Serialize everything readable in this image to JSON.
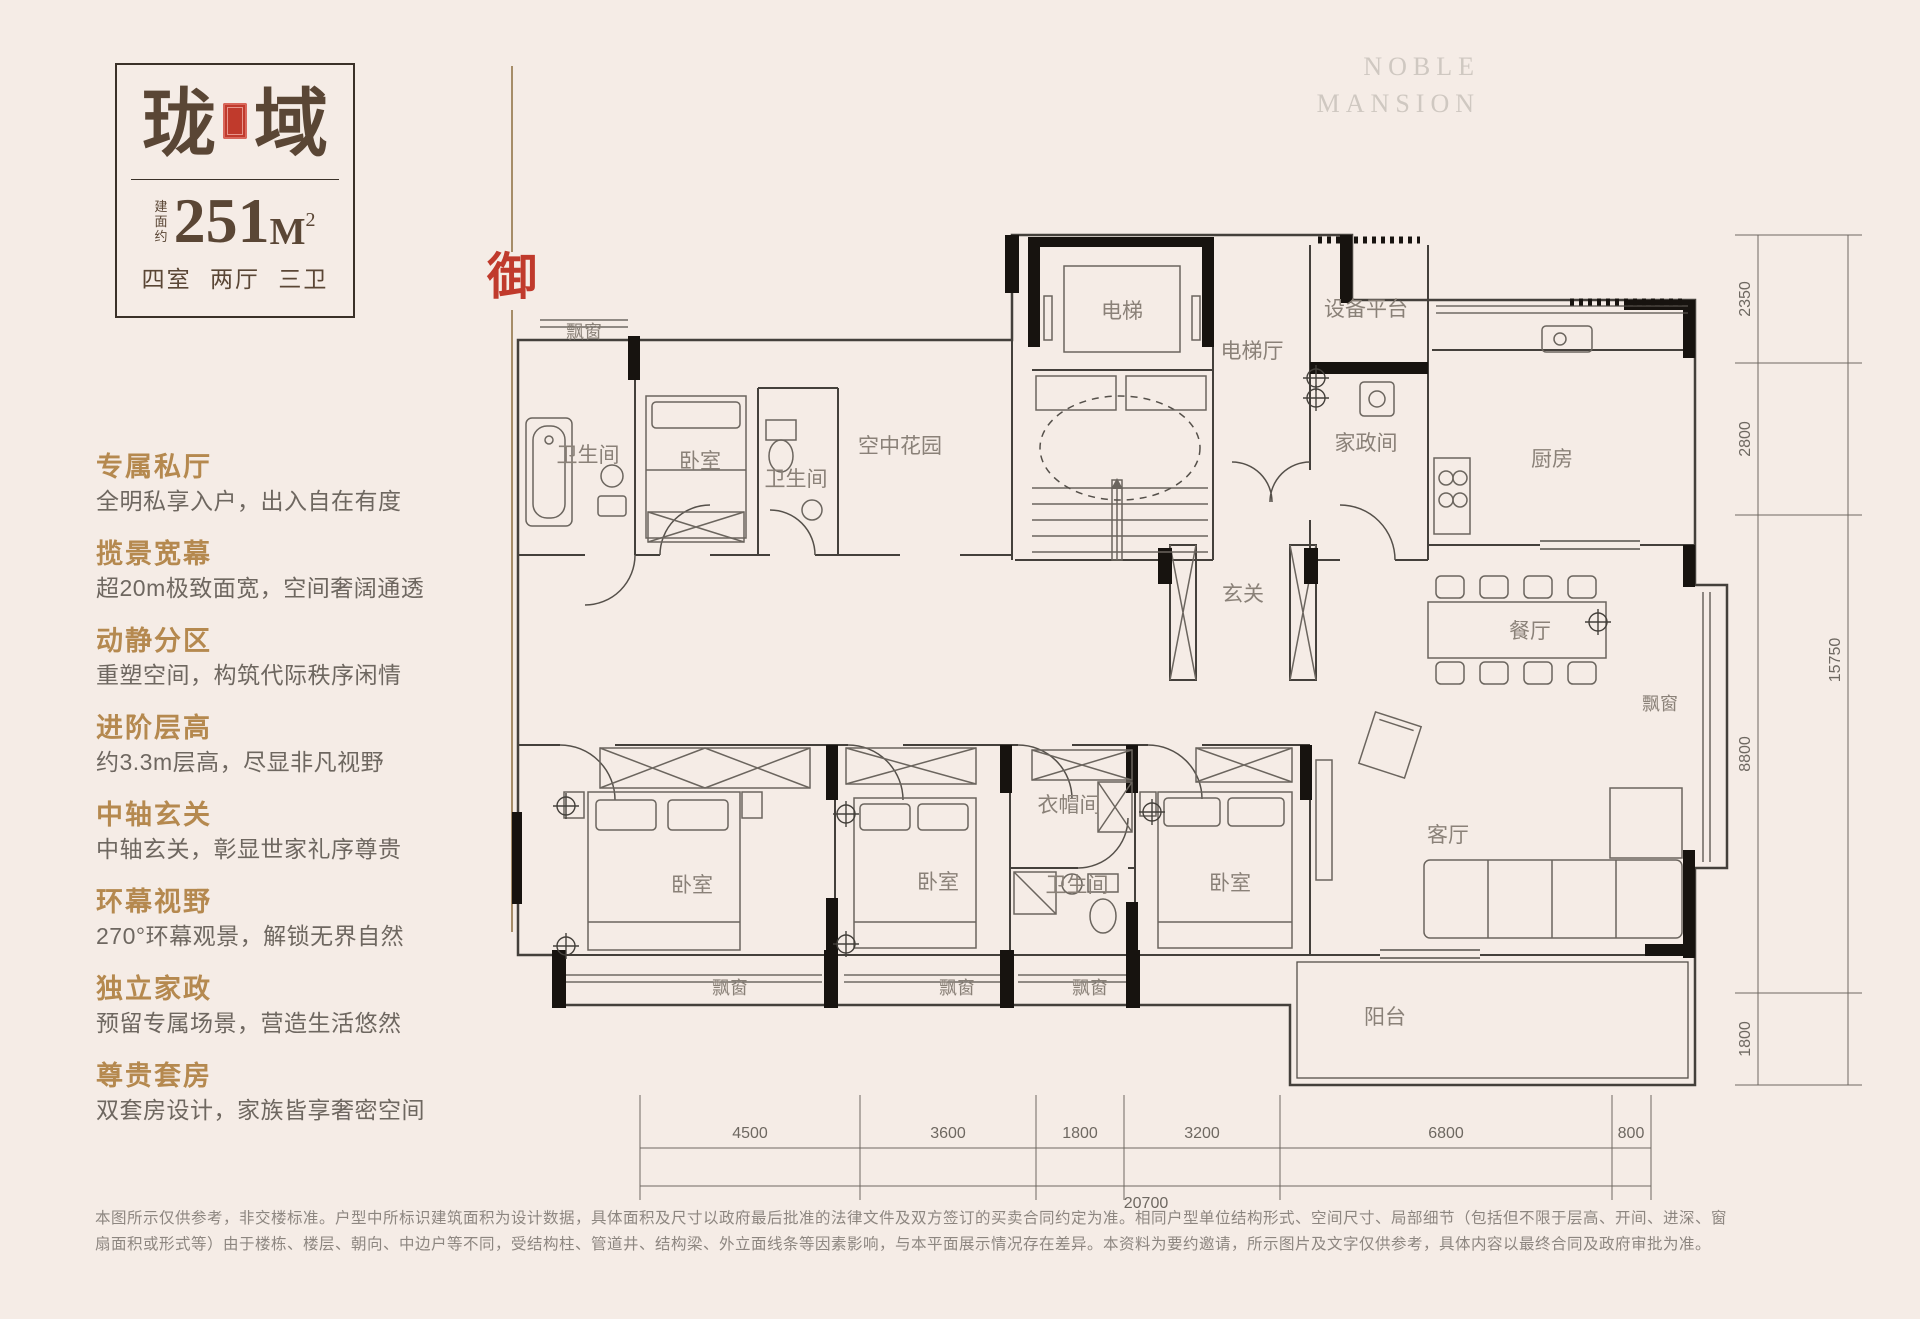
{
  "colors": {
    "background": "#f5ece6",
    "title_brown": "#5a4635",
    "accent_gold": "#b5894f",
    "seal_red": "#c03a2c",
    "divider_tan": "#a68d68"
  },
  "brand": {
    "en_line1": "NOBLE",
    "en_line2": "MANSION",
    "seal_char": "御"
  },
  "title_card": {
    "name_char1": "珑",
    "name_char2": "域",
    "seal_icon": "red-seal",
    "area_prefix_chars": {
      "c1": "建",
      "c2": "面",
      "c3": "约"
    },
    "area_value": "251",
    "area_unit": "M",
    "area_sup": "2",
    "layout_text": "四室 两厅 三卫"
  },
  "features": [
    {
      "title": "专属私厅",
      "desc": "全明私享入户，出入自在有度"
    },
    {
      "title": "揽景宽幕",
      "desc": "超20m极致面宽，空间奢阔通透"
    },
    {
      "title": "动静分区",
      "desc": "重塑空间，构筑代际秩序闲情"
    },
    {
      "title": "进阶层高",
      "desc": "约3.3m层高，尽显非凡视野"
    },
    {
      "title": "中轴玄关",
      "desc": "中轴玄关，彰显世家礼序尊贵"
    },
    {
      "title": "环幕视野",
      "desc": "270°环幕观景，解锁无界自然"
    },
    {
      "title": "独立家政",
      "desc": "预留专属场景，营造生活悠然"
    },
    {
      "title": "尊贵套房",
      "desc": "双套房设计，家族皆享奢密空间"
    }
  ],
  "plan": {
    "room_labels": [
      "电梯",
      "电梯厅",
      "设备平台",
      "家政间",
      "厨房",
      "空中花园",
      "飘窗",
      "卫生间",
      "卧室",
      "卫生间",
      "玄关",
      "餐厅",
      "飘窗",
      "客厅",
      "衣帽间",
      "卫生间",
      "卧室",
      "卧室",
      "卧室",
      "飘窗",
      "飘窗",
      "飘窗",
      "阳台"
    ],
    "dims_right": [
      "2350",
      "2800",
      "8800",
      "1800"
    ],
    "dims_right_total": "15750",
    "dims_bottom": [
      "4500",
      "3600",
      "1800",
      "3200",
      "6800",
      "800"
    ],
    "dims_bottom_total": "20700"
  },
  "disclaimer": {
    "line1": "本图所示仅供参考，非交楼标准。户型中所标识建筑面积为设计数据，具体面积及尺寸以政府最后批准的法律文件及双方签订的买卖合同约定为准。相同户型单位结构形式、空间尺寸、局部细节（包括但不限于层高、开间、进深、窗",
    "line2": "扇面积或形式等）由于楼栋、楼层、朝向、中边户等不同，受结构柱、管道井、结构梁、外立面线条等因素影响，与本平面展示情况存在差异。本资料为要约邀请，所示图片及文字仅供参考，具体内容以最终合同及政府审批为准。"
  }
}
